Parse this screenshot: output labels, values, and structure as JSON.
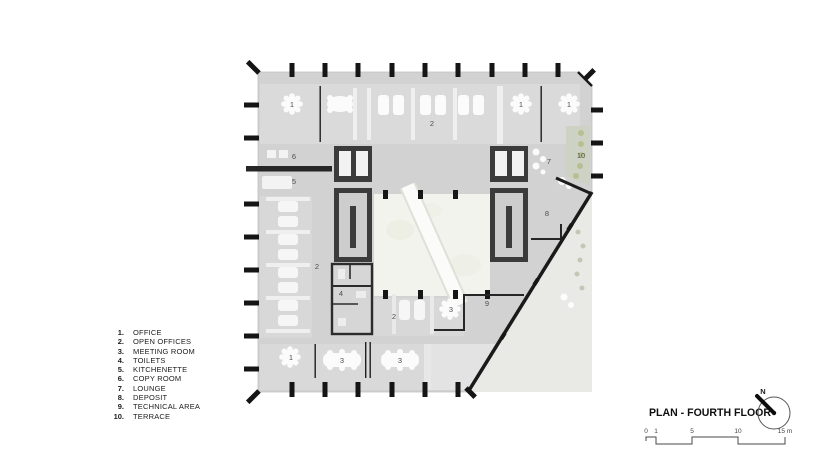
{
  "legend": {
    "items": [
      {
        "num": "1.",
        "label": "OFFICE"
      },
      {
        "num": "2.",
        "label": "OPEN OFFICES"
      },
      {
        "num": "3.",
        "label": "MEETING ROOM"
      },
      {
        "num": "4.",
        "label": "TOILETS"
      },
      {
        "num": "5.",
        "label": "KITCHENETTE"
      },
      {
        "num": "6.",
        "label": "COPY ROOM"
      },
      {
        "num": "7.",
        "label": "LOUNGE"
      },
      {
        "num": "8.",
        "label": "DEPOSIT"
      },
      {
        "num": "9.",
        "label": "TECHNICAL AREA"
      },
      {
        "num": "10.",
        "label": "TERRACE"
      }
    ]
  },
  "plan": {
    "room_labels": [
      {
        "text": "1"
      },
      {
        "text": "2"
      },
      {
        "text": "1"
      },
      {
        "text": "1"
      },
      {
        "text": "6"
      },
      {
        "text": "7"
      },
      {
        "text": "10"
      },
      {
        "text": "5"
      },
      {
        "text": "8"
      },
      {
        "text": "2"
      },
      {
        "text": "4"
      },
      {
        "text": "2"
      },
      {
        "text": "3"
      },
      {
        "text": "9"
      },
      {
        "text": "1"
      },
      {
        "text": "3"
      },
      {
        "text": "3"
      }
    ],
    "colors": {
      "floor": "#d2d2d2",
      "room_tint": "#dadada",
      "wall": "#3b3b3b",
      "column": "#151515",
      "atrium": "#f2f3ec",
      "terrace_lower": "#e9eae6",
      "terrace_strip": "#ced2c4",
      "plant": "#b7bf90",
      "furniture": "#fbfbfb",
      "label": "#4e4e4e"
    }
  },
  "titleblock": {
    "title": "PLAN - FOURTH FLOOR",
    "north_label": "N",
    "scale": {
      "ticks": [
        "0",
        "1",
        "5",
        "10",
        "15 m"
      ]
    }
  }
}
